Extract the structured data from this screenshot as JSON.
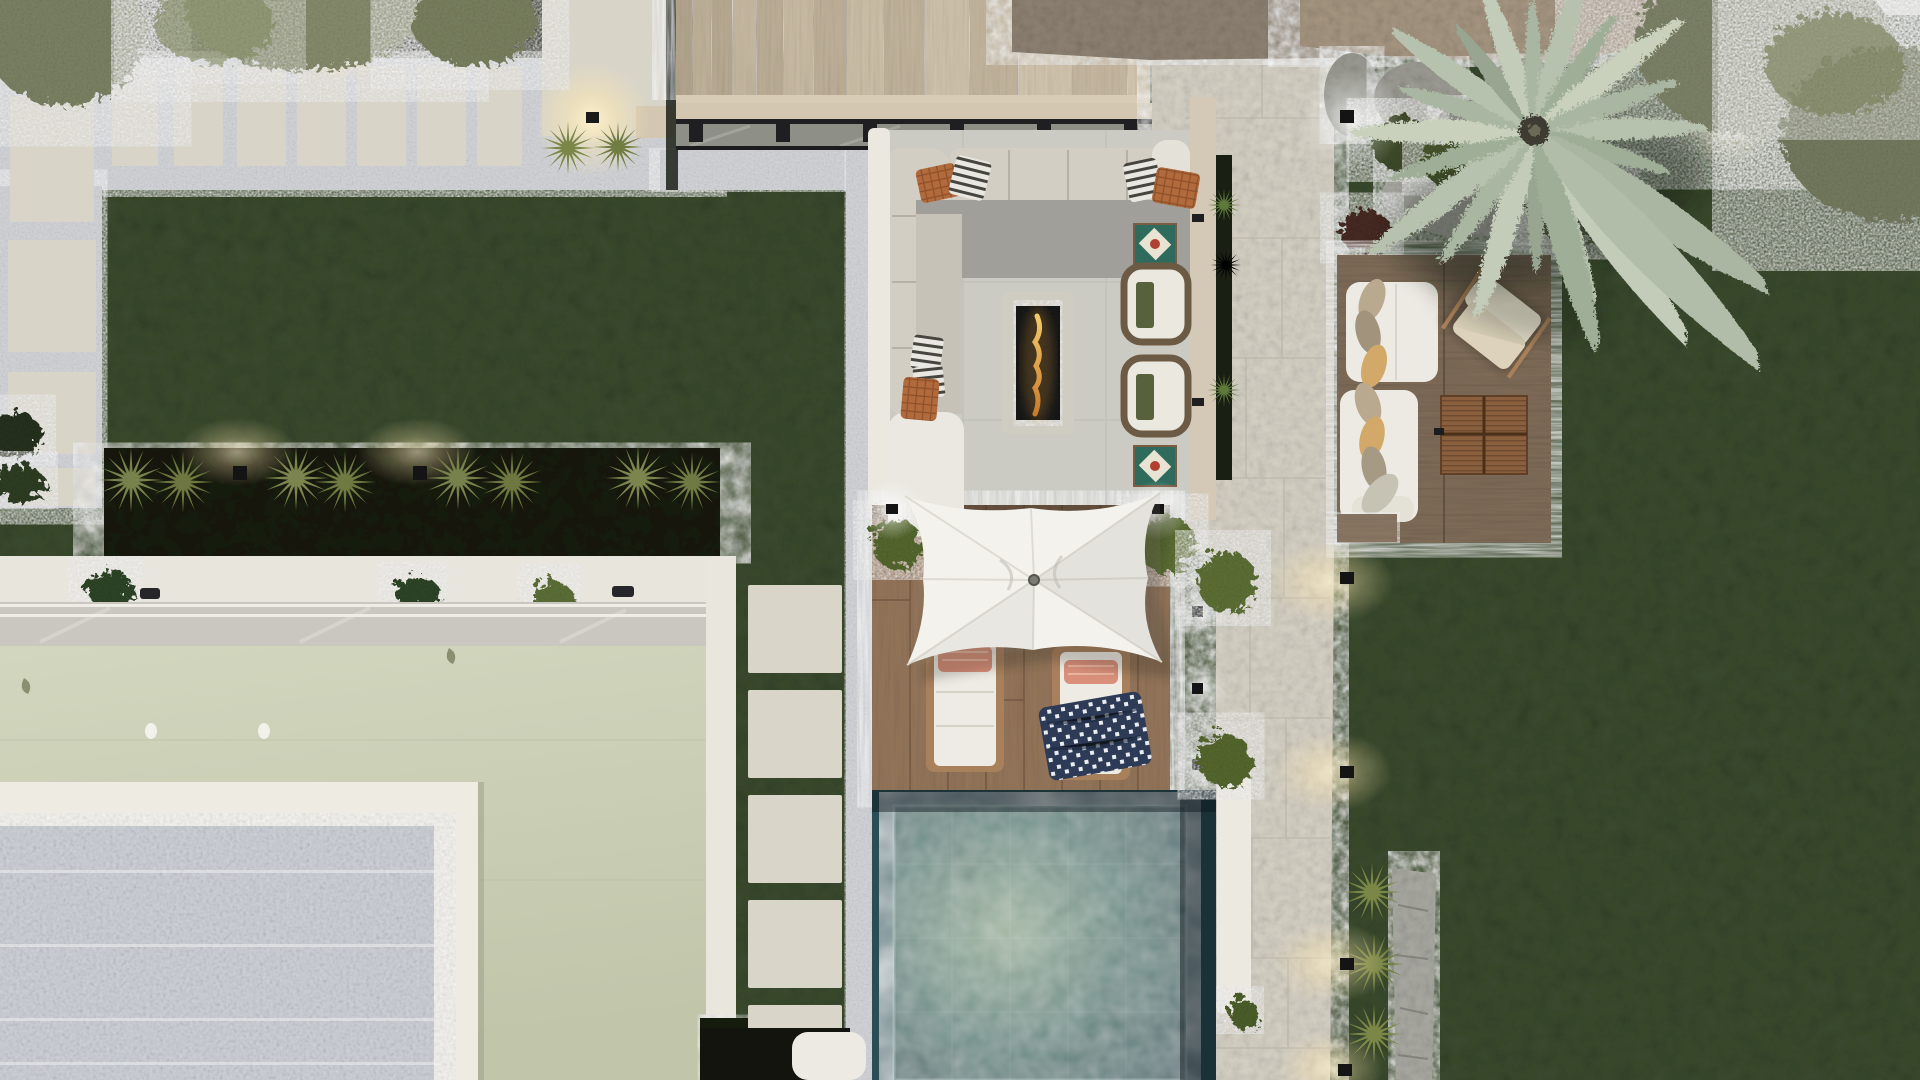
{
  "view": {
    "type": "aerial-top-down-render",
    "description": "Photorealistic dusk top view of a villa garden: lounge terrace with pergola, wooden deck with square umbrella and sun loungers, plunge pool, sage-green flat roof with white-framed pebble roof section, gravel paths with concrete pavers, lawns, palm and olive trees, rock garden and garden lights",
    "width_px": 1920,
    "height_px": 1080
  },
  "colors": {
    "lawn": "#3a4a2e",
    "bedSoil": "#161b10",
    "gravel": "#d2d4d8",
    "paver": "#d8d4c8",
    "stairs": "#c2b39b",
    "rubble": "#8d8172",
    "rockTan": "#a59581",
    "boulderGray": "#9a9a92",
    "rockPale": "#a9a9a2",
    "pathTile": "#d6d1c5",
    "terraceTile": "#cbcbc4",
    "borderWhite": "#ebe8e0",
    "borderBeige": "#d4c9b6",
    "pergolaBeam": "#d3c7b2",
    "pergolaSteel": "#1f1f22",
    "sofaBeige": "#d2cec3",
    "seatGray": "#a19f99",
    "chaiseWhite": "#eae8e1",
    "pillowRust": "#b06a3c",
    "pillowStripeDark": "#46463f",
    "throwOlive": "#57613c",
    "firePebbles": "#141518",
    "flame": "#e8a33c",
    "armchairFrame": "#6d5a44",
    "cushionWhite": "#eae8df",
    "mosaicTeal": "#2e6b5c",
    "mosaicRed": "#b0402f",
    "deckWood": "#93755a",
    "loungerWood": "#a8805c",
    "loungerCushion": "#edebe3",
    "pillowCoral": "#d9907a",
    "towelNavy": "#2d3b56",
    "umbrella": "#f3f2ed",
    "poolMid": "#4f7a74",
    "poolLight": "#9fb59b",
    "poolDark": "#2b4d55",
    "poolWall": "#ece9e0",
    "platformWood": "#7e6b58",
    "daybedWhite": "#eceae2",
    "pillowTan": "#d2a969",
    "pillowTaupe": "#b9a98f",
    "butterflyChair": "#e9e2cf",
    "tableWood": "#8a5f3d",
    "roofSage": "#c9cdb3",
    "parapetWhite": "#edebe2",
    "pebbleRoof": "#ced1d8",
    "hedgeDark": "#161d12",
    "shrubOlive": "#77814b",
    "bushGreen": "#5d7034",
    "oliveTree": "#7c8264",
    "palmFrond": "#b7c2ae",
    "yucca": "#8f9e50",
    "redShrub": "#472c20",
    "monstera": "#2f4425",
    "stoolWhite": "#eceae2",
    "skyStrip": "#d6d6d2",
    "glowWarm": "#ffe9b0"
  },
  "areas": {
    "lawns": [
      {
        "name": "upper-left-lawn"
      },
      {
        "name": "center-strip-lawn"
      },
      {
        "name": "right-lawn"
      }
    ],
    "gravel_band_top": {
      "pavers": 7,
      "corner_slab": 1,
      "large_slab_with_light": 1
    },
    "gravel_path_left": {
      "pavers": 4
    },
    "stepping_stone_column": {
      "square_pavers": 5
    },
    "staircase": {
      "treads": 14
    },
    "stone_path_right": {
      "material": "large beige tiles"
    },
    "pool": {
      "shape": "rectangular",
      "water": "turquoise marbled",
      "side_wall": "white parapet"
    },
    "main_deck": {
      "plank_direction": "vertical"
    },
    "platform_deck": {
      "plank_direction": "horizontal"
    },
    "green_roof": {
      "vents": 2,
      "leaf_accents": 2
    },
    "pebble_roof_terrace": {
      "border": "white parapet frame",
      "light_bands": 4
    },
    "rock_garden_top_right": {
      "boulders": 4,
      "shrubs": 3
    },
    "rock_border_bottom_right": {
      "grass_tufts": 3
    }
  },
  "furniture": {
    "terrace_lounge": {
      "sectional_sofa": {
        "back_cushions": 7,
        "rust_pillows": 3,
        "striped_pillows": 4,
        "chaise": 1
      },
      "fire_pit": {
        "fill": "black pebbles",
        "flame": true
      },
      "armchairs": 2,
      "olive_throws": 2,
      "mosaic_side_tables": 2
    },
    "deck_zone": {
      "umbrella": {
        "shape": "square",
        "color": "white"
      },
      "sun_loungers": 2,
      "coral_head_pillows": 2,
      "navy_polka_towel": 1,
      "boxwood_bushes": 2
    },
    "platform_zone": {
      "daybed_sofas": 2,
      "leaf_pillows": 7,
      "butterfly_chair": 1,
      "slatted_coffee_table_panels": 4
    },
    "misc": {
      "white_stool_bottom_left": 1
    }
  },
  "plants": {
    "olive_canopies_top_left": 3,
    "olive_canopies_top_right": 3,
    "palm_tree": 1,
    "spiky_shrub_row": 8,
    "grass_tufts_by_slab": 2,
    "path_edge_grasses": 3,
    "planter_tufts": 3,
    "monstera_glimpses": 2,
    "yucca_pair": 2,
    "red_shrub": 1
  },
  "lighting": {
    "bollard_lights_top_bed": 2,
    "slab_wall_light": 1,
    "bed_cube_lights": 2,
    "deck_corner_leds": 2,
    "pergola_post_leds": 3,
    "path_edge_cube_lights": 4,
    "boulder_light": 1,
    "yucca_light": 1,
    "fire_pit_glow": 1
  }
}
